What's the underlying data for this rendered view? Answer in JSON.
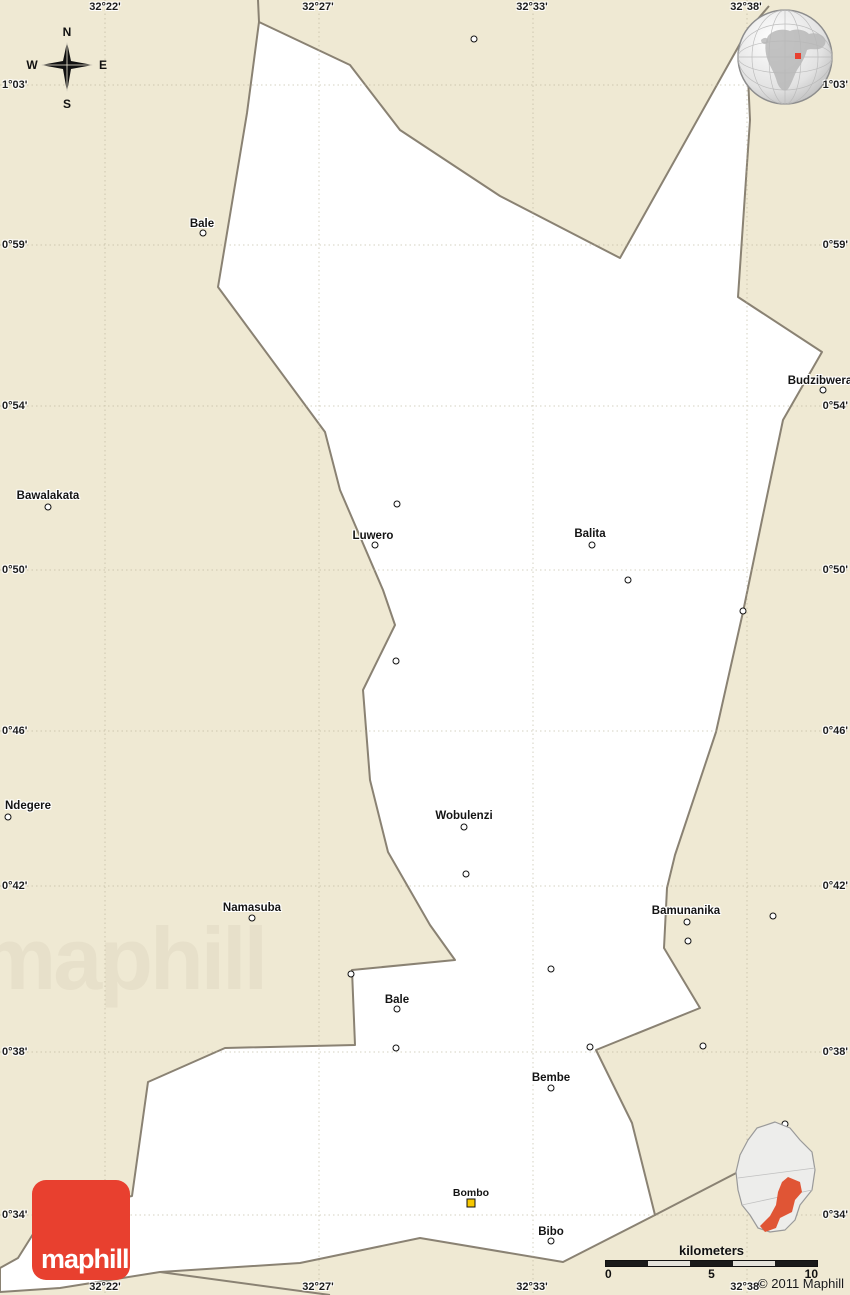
{
  "map": {
    "colors": {
      "background": "#efe9d3",
      "district_fill": "#ffffff",
      "boundary": "#8a8273",
      "grid": "#c9c1a6",
      "logo_red": "#e8402f",
      "locator_highlight": "#e05535",
      "town_marker_yellow": "#f7c800"
    },
    "grid": {
      "top_labels": [
        "32°22'",
        "32°27'",
        "32°33'",
        "32°38'"
      ],
      "bottom_labels": [
        "32°22'",
        "32°27'",
        "32°33'",
        "32°38'"
      ],
      "left_labels": [
        "1°03'",
        "0°59'",
        "0°54'",
        "0°50'",
        "0°46'",
        "0°42'",
        "0°38'",
        "0°34'"
      ],
      "right_labels": [
        "1°03'",
        "0°59'",
        "0°54'",
        "0°50'",
        "0°46'",
        "0°42'",
        "0°38'",
        "0°34'"
      ]
    },
    "compass": {
      "n": "N",
      "e": "E",
      "s": "S",
      "w": "W"
    },
    "places": [
      {
        "name": "Bale"
      },
      {
        "name": "Budzibwera"
      },
      {
        "name": "Bawalakata"
      },
      {
        "name": "Luwero"
      },
      {
        "name": "Balita"
      },
      {
        "name": "Ndegere"
      },
      {
        "name": "Wobulenzi"
      },
      {
        "name": "Namasuba"
      },
      {
        "name": "Bamunanika"
      },
      {
        "name": "Bale"
      },
      {
        "name": "Bembe"
      },
      {
        "name": "Bombo"
      },
      {
        "name": "Bibo"
      }
    ],
    "scale_bar": {
      "title": "kilometers",
      "tick_0": "0",
      "tick_5": "5",
      "tick_10": "10"
    },
    "logo_text": "maphill",
    "watermark_text": "maphill",
    "copyright": "© 2011 Maphill"
  }
}
